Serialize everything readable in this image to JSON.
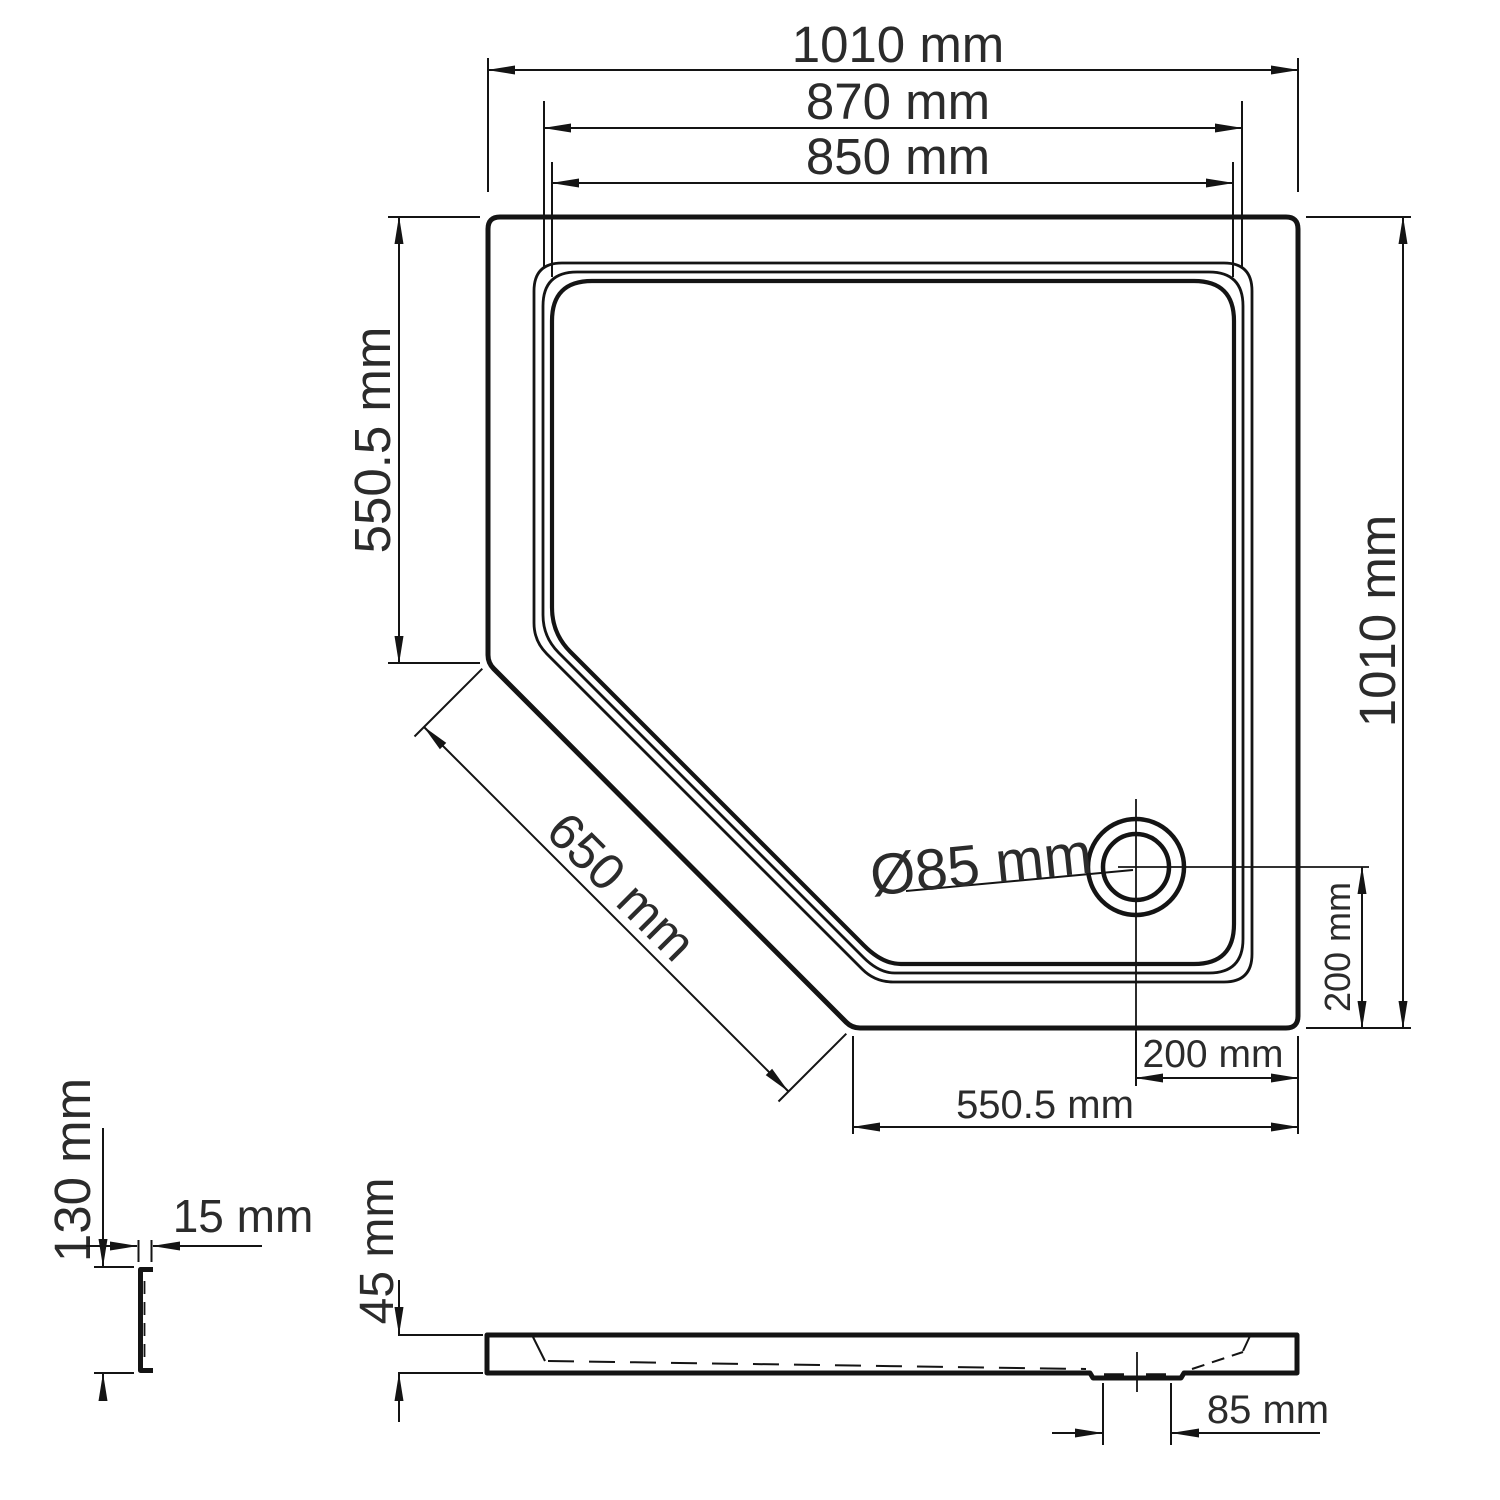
{
  "top_view": {
    "dim_overall_width": "1010 mm",
    "dim_rim_width": "870 mm",
    "dim_inner_width": "850 mm",
    "dim_left_edge": "550.5 mm",
    "dim_right_edge": "1010 mm",
    "dim_chamfer": "650 mm",
    "drain_diameter": "Ø85 mm",
    "dim_drain_to_bottom": "200 mm",
    "dim_drain_to_right": "200 mm",
    "dim_bottom_edge": "550.5 mm"
  },
  "side_view": {
    "dim_thickness": "45 mm",
    "dim_drain_boss": "85 mm"
  },
  "edge_detail": {
    "dim_flange_height": "130 mm",
    "dim_flange_width": "15 mm"
  }
}
